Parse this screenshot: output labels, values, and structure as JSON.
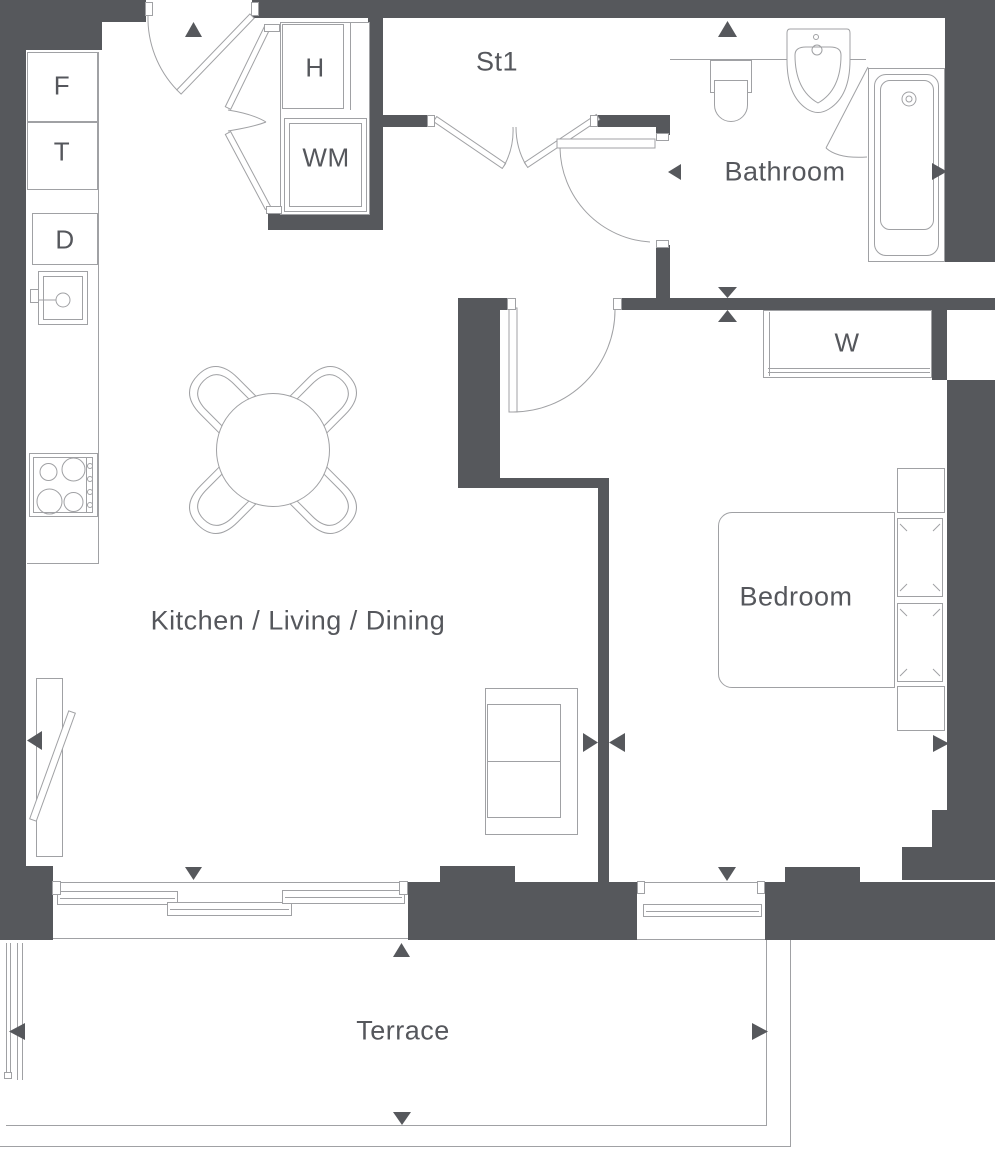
{
  "plan": {
    "title": "Apartment floor plan",
    "rooms": {
      "kitchen_living_dining": "Kitchen / Living / Dining",
      "bedroom": "Bedroom",
      "bathroom": "Bathroom",
      "store": "St1",
      "terrace": "Terrace"
    },
    "fixtures": {
      "f": "F",
      "t": "T",
      "d": "D",
      "h": "H",
      "wm": "WM",
      "w": "W"
    },
    "colors": {
      "wall": "#56585c",
      "line": "#a0a1a4",
      "text": "#55575c",
      "background": "#ffffff"
    },
    "icons": {
      "direction_markers": [
        "triangle-up-icon",
        "triangle-down-icon",
        "triangle-left-icon",
        "triangle-right-icon"
      ]
    }
  }
}
